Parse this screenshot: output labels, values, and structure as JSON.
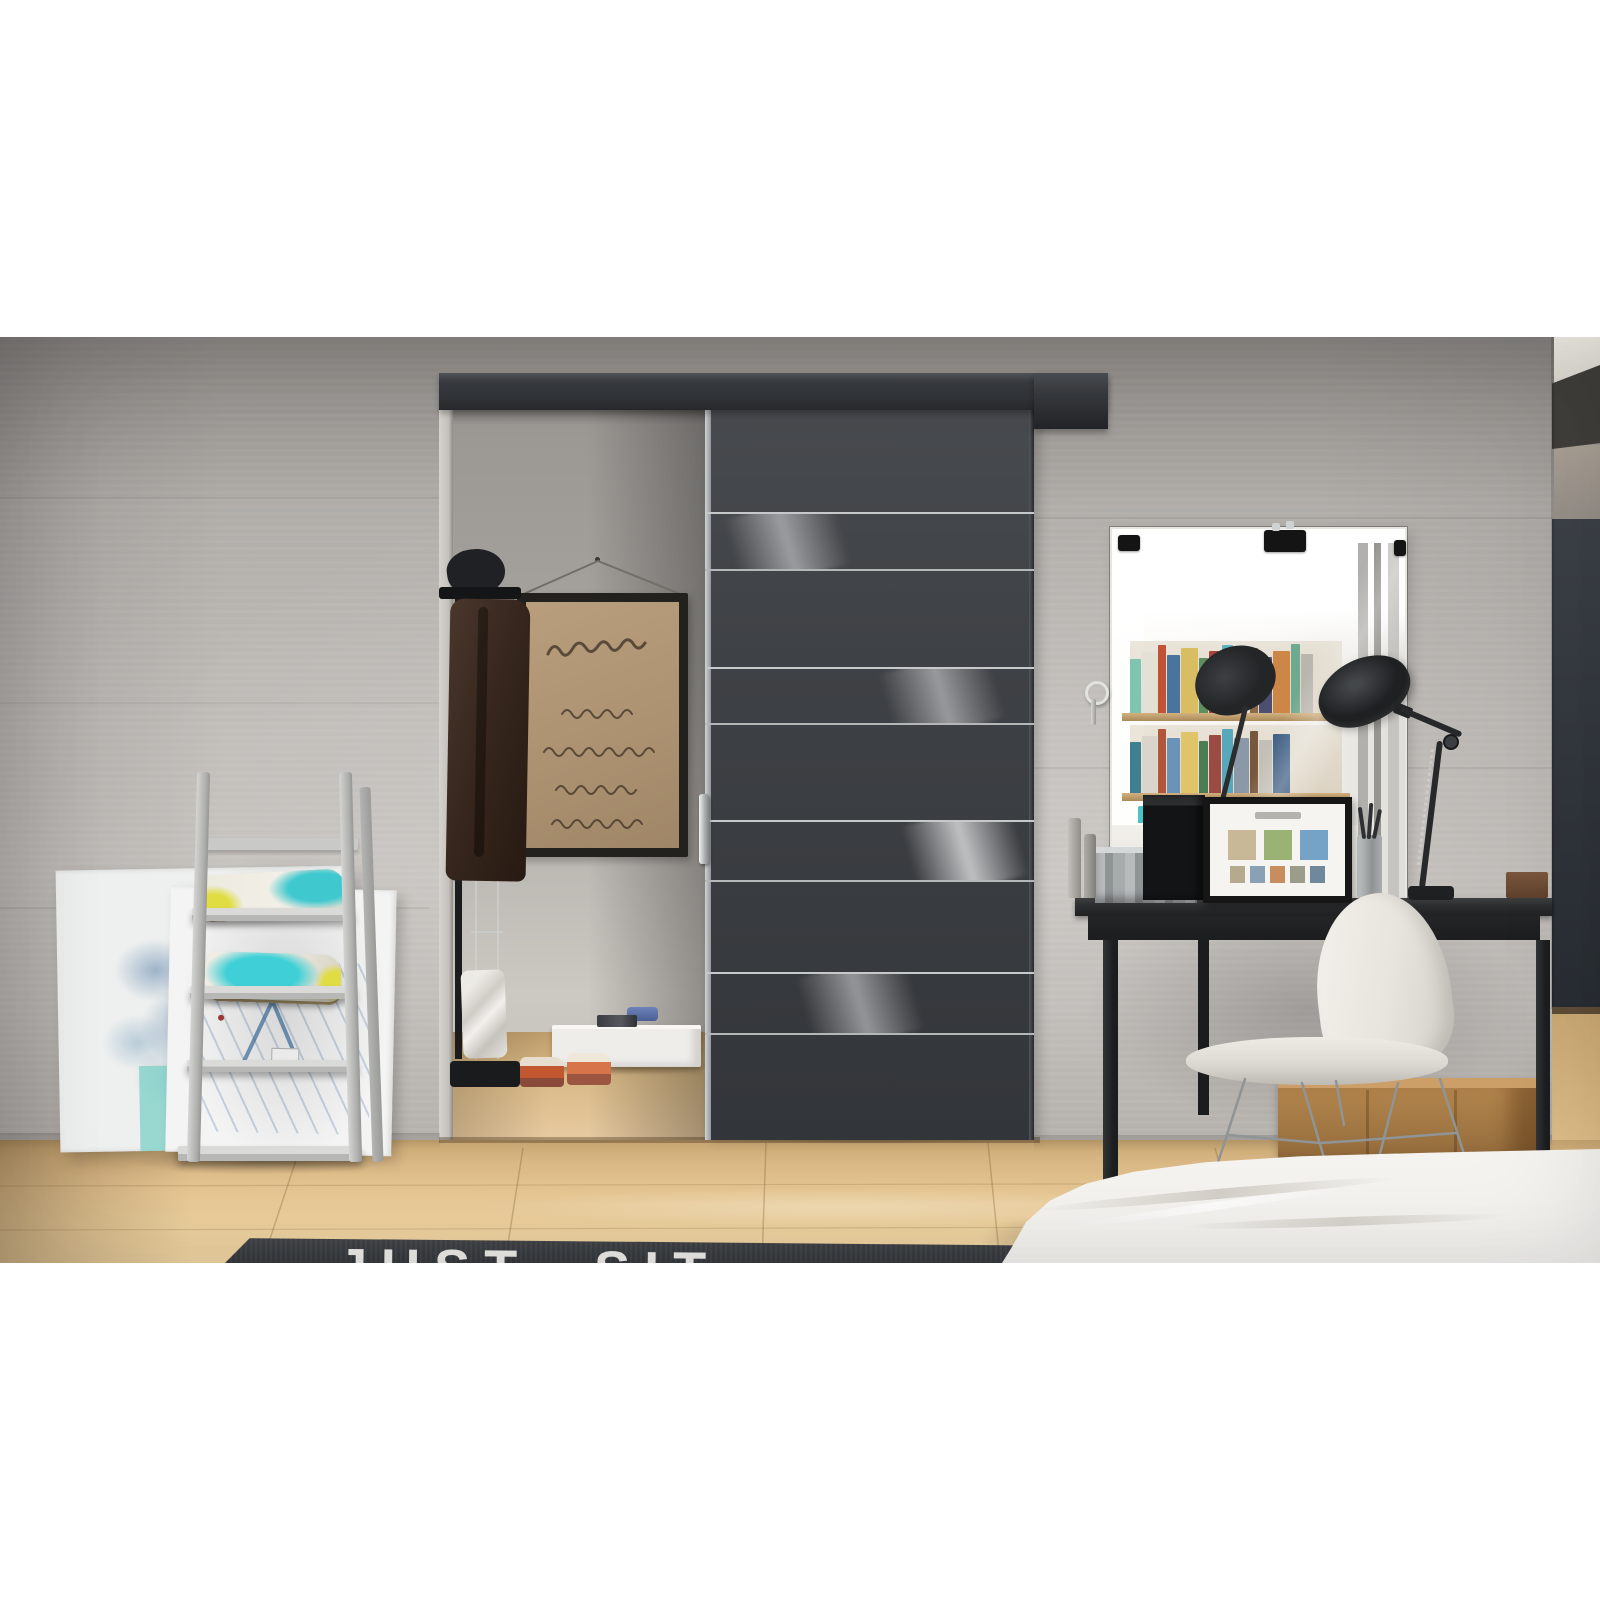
{
  "meta": {
    "description": "Interior render photo: black sliding door with four white glass stripes on a rail, concrete wall, closet niche with script poster and coat, ladder shelf with pillows and abstract canvases, vanity mirror with desk, lamp and white shell chair, wood floor, dark rug and white bed",
    "canvas": {
      "width": 1600,
      "height": 1600
    },
    "photo_area": {
      "top": 337,
      "height": 926
    }
  },
  "palette": {
    "letterbox": "#ffffff",
    "wall_concrete": "#bdbab6",
    "door_graphite": "#3e4145",
    "door_stripe_glass": "#ececea",
    "rail": "#33363a",
    "wood_floor": "#e6c794",
    "rug": "#3b3e42",
    "rug_letters": "#edece8",
    "bed_linen": "#f4f3f0",
    "pillow_teal": "#3ed0d6",
    "pillow_yellow": "#e0dd42",
    "poster_paper": "#b1976f",
    "coat_brown": "#3a2a20",
    "dark_side_panel": "#31363c",
    "crate_wood": "#b8894f",
    "chair_shell": "#efece6"
  },
  "scene": {
    "door": {
      "label": "sliding door",
      "stripe_count": 4
    },
    "rail": {
      "label": "wall-mounted sliding rail"
    },
    "closet": {
      "poster": {
        "label": "framed script poster",
        "line_count": 5
      },
      "coat_rack": {
        "label": "coat rack with dark coat"
      },
      "floor_items": [
        "white storage box",
        "blue cloth",
        "espadrille shoes",
        "white bag"
      ]
    },
    "mirror": {
      "label": "vanity mirror",
      "clip_count": 3,
      "reflection": {
        "books_row1": [
          "#7ec4ae",
          "#e3e0d6",
          "#c05236",
          "#49759c",
          "#d9bd62",
          "#5d8f5f",
          "#aa4440",
          "#63b2c4",
          "#e7e2d7",
          "#8a6a49",
          "#4d4e70",
          "#cc8747",
          "#6fa98f",
          "#b9b6ae"
        ],
        "books_row2": [
          "#3f7f8f",
          "#d9d5cc",
          "#b0563a",
          "#6a93b8",
          "#e0c46a",
          "#4c7d52",
          "#9c4a44",
          "#58a8bc",
          "#8a98a8",
          "#77573d",
          "#c2bfb6",
          "#3f5f84"
        ],
        "bottles": [
          "#49c2c8",
          "#7fb069",
          "#d9d5cc",
          "#5a8fb0",
          "#c2bfb6",
          "#3fa0a8"
        ]
      }
    },
    "desk": {
      "label": "black console desk",
      "items": [
        "galvanized metal box",
        "black speaker box",
        "framed photo collage",
        "brush cup",
        "perfume bottles",
        "small brown box"
      ],
      "collage_mid_thumbs": [
        "#c9b897",
        "#9ab374",
        "#74a3c7"
      ],
      "collage_small_thumbs": [
        "#b5a98e",
        "#8aa0b5",
        "#c78d5e",
        "#9c9c8a",
        "#70889c"
      ]
    },
    "lamp": {
      "label": "black articulated desk lamp"
    },
    "chair": {
      "label": "white shell chair with wire base"
    },
    "crate": {
      "label": "wooden crate"
    },
    "ladder_shelf": {
      "label": "leaning ladder shelf",
      "shelf_count": 4,
      "pillow_count": 2
    },
    "canvases": {
      "label": "abstract canvases leaning on wall",
      "count": 2
    },
    "rug": {
      "text": "JUST SIT"
    },
    "bed": {
      "label": "white bed corner"
    }
  }
}
